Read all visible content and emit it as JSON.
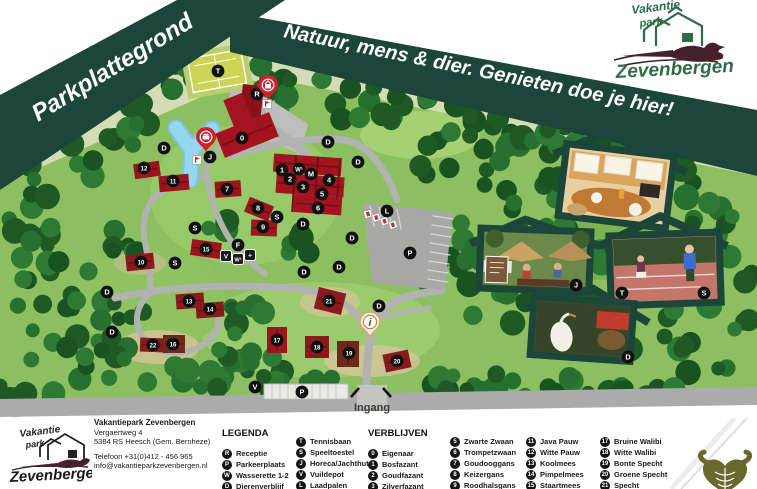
{
  "banner": {
    "title": "Parkplattegrond",
    "slogan": "Natuur, mens & dier. Genieten doe je hier!"
  },
  "brand": {
    "top": "Vakantie",
    "mid": "park",
    "name": "Zevenbergen"
  },
  "map": {
    "entrance_label": "Ingang",
    "markers": [
      {
        "x": 218,
        "y": 71,
        "t": "T"
      },
      {
        "x": 257,
        "y": 94,
        "t": "R"
      },
      {
        "x": 242,
        "y": 138,
        "t": "0"
      },
      {
        "x": 164,
        "y": 148,
        "t": "D"
      },
      {
        "x": 210,
        "y": 157,
        "t": "J"
      },
      {
        "x": 144,
        "y": 168,
        "t": "12"
      },
      {
        "x": 282,
        "y": 170,
        "t": "1"
      },
      {
        "x": 299,
        "y": 169,
        "t": "W¹"
      },
      {
        "x": 311,
        "y": 174,
        "t": "M"
      },
      {
        "x": 290,
        "y": 179,
        "t": "2"
      },
      {
        "x": 173,
        "y": 181,
        "t": "11"
      },
      {
        "x": 329,
        "y": 180,
        "t": "4"
      },
      {
        "x": 303,
        "y": 187,
        "t": "3"
      },
      {
        "x": 227,
        "y": 189,
        "t": "7"
      },
      {
        "x": 322,
        "y": 194,
        "t": "5"
      },
      {
        "x": 318,
        "y": 208,
        "t": "6"
      },
      {
        "x": 258,
        "y": 208,
        "t": "8"
      },
      {
        "x": 387,
        "y": 211,
        "t": "L"
      },
      {
        "x": 277,
        "y": 217,
        "t": "S"
      },
      {
        "x": 263,
        "y": 227,
        "t": "9"
      },
      {
        "x": 195,
        "y": 228,
        "t": "S"
      },
      {
        "x": 303,
        "y": 224,
        "t": "D"
      },
      {
        "x": 328,
        "y": 142,
        "t": "D"
      },
      {
        "x": 358,
        "y": 162,
        "t": "D"
      },
      {
        "x": 352,
        "y": 238,
        "t": "D"
      },
      {
        "x": 238,
        "y": 245,
        "t": "F"
      },
      {
        "x": 206,
        "y": 249,
        "t": "15"
      },
      {
        "x": 410,
        "y": 253,
        "t": "P"
      },
      {
        "x": 141,
        "y": 262,
        "t": "10"
      },
      {
        "x": 175,
        "y": 263,
        "t": "S"
      },
      {
        "x": 339,
        "y": 267,
        "t": "D"
      },
      {
        "x": 304,
        "y": 272,
        "t": "D"
      },
      {
        "x": 107,
        "y": 292,
        "t": "D"
      },
      {
        "x": 189,
        "y": 301,
        "t": "13"
      },
      {
        "x": 329,
        "y": 301,
        "t": "21"
      },
      {
        "x": 379,
        "y": 306,
        "t": "D"
      },
      {
        "x": 210,
        "y": 309,
        "t": "14"
      },
      {
        "x": 112,
        "y": 332,
        "t": "D"
      },
      {
        "x": 277,
        "y": 340,
        "t": "17"
      },
      {
        "x": 173,
        "y": 344,
        "t": "16"
      },
      {
        "x": 153,
        "y": 345,
        "t": "22"
      },
      {
        "x": 317,
        "y": 347,
        "t": "18"
      },
      {
        "x": 349,
        "y": 353,
        "t": "19"
      },
      {
        "x": 397,
        "y": 361,
        "t": "20"
      },
      {
        "x": 255,
        "y": 387,
        "t": "V"
      },
      {
        "x": 302,
        "y": 392,
        "t": "P"
      },
      {
        "x": 622,
        "y": 293,
        "t": "T"
      },
      {
        "x": 704,
        "y": 293,
        "t": "S"
      },
      {
        "x": 576,
        "y": 285,
        "t": "J"
      },
      {
        "x": 628,
        "y": 357,
        "t": "D"
      }
    ],
    "squares": [
      {
        "x": 226,
        "y": 256,
        "t": "V"
      },
      {
        "x": 238,
        "y": 259,
        "t": "W²"
      },
      {
        "x": 250,
        "y": 255,
        "t": "+"
      }
    ],
    "pins": [
      {
        "x": 268,
        "y": 100,
        "icon": "reception-pin",
        "t": ""
      },
      {
        "x": 206,
        "y": 152,
        "icon": "restaurant-pin",
        "t": ""
      },
      {
        "x": 370,
        "y": 337,
        "icon": "info-pin",
        "t": "i"
      }
    ]
  },
  "footer": {
    "address": {
      "name": "Vakantiepark Zevenbergen",
      "street": "Vergaertweg 4",
      "city": "5384 RS Heesch (Gem. Bernheze)",
      "phone": "Telefoon +31(0)412 - 456 965",
      "email": "info@vakantieparkzevenbergen.nl"
    },
    "legenda": {
      "title": "LEGENDA",
      "columns": [
        [
          {
            "k": "R",
            "label": "Receptie"
          },
          {
            "k": "P",
            "label": "Parkeerplaats"
          },
          {
            "k": "W",
            "label": "Wasserette 1-2"
          },
          {
            "k": "D",
            "label": "Dierenverblijf"
          }
        ],
        [
          {
            "k": "T",
            "label": "Tennisbaan"
          },
          {
            "k": "S",
            "label": "Speeltoestel"
          },
          {
            "k": "J",
            "label": "Horeca/Jachthut"
          },
          {
            "k": "V",
            "label": "Vuildepot"
          },
          {
            "k": "L",
            "label": "Laadpalen"
          }
        ]
      ]
    },
    "verblijven": {
      "title": "VERBLIJVEN",
      "columns": [
        [
          {
            "k": "0",
            "label": "Eigenaar"
          },
          {
            "k": "1",
            "label": "Bosfazant"
          },
          {
            "k": "2",
            "label": "Goudfazant"
          },
          {
            "k": "3",
            "label": "Zilverfazant"
          }
        ],
        [
          {
            "k": "5",
            "label": "Zwarte Zwaan"
          },
          {
            "k": "6",
            "label": "Trompetzwaan"
          },
          {
            "k": "7",
            "label": "Goudooggans"
          },
          {
            "k": "8",
            "label": "Keizergans"
          },
          {
            "k": "9",
            "label": "Roodhalsgans"
          }
        ],
        [
          {
            "k": "11",
            "label": "Java Pauw"
          },
          {
            "k": "12",
            "label": "Witte Pauw"
          },
          {
            "k": "13",
            "label": "Koolmees"
          },
          {
            "k": "14",
            "label": "Pimpelmees"
          },
          {
            "k": "15",
            "label": "Staartmees"
          }
        ],
        [
          {
            "k": "17",
            "label": "Bruine Walibi"
          },
          {
            "k": "18",
            "label": "Witte Walibi"
          },
          {
            "k": "19",
            "label": "Bonte Specht"
          },
          {
            "k": "20",
            "label": "Groene Specht"
          },
          {
            "k": "21",
            "label": "Specht"
          }
        ]
      ]
    }
  },
  "colors": {
    "banner": "#1b4639",
    "forest": "#235f28",
    "lawn": "#8cbf60",
    "building": "#a31420",
    "road": "#b2b2b0",
    "pond": "#93d4ee",
    "accent_red": "#d21f2c",
    "logo_green": "#2f6b45",
    "pheasant": "#46212c",
    "horns": "#6a692d"
  }
}
